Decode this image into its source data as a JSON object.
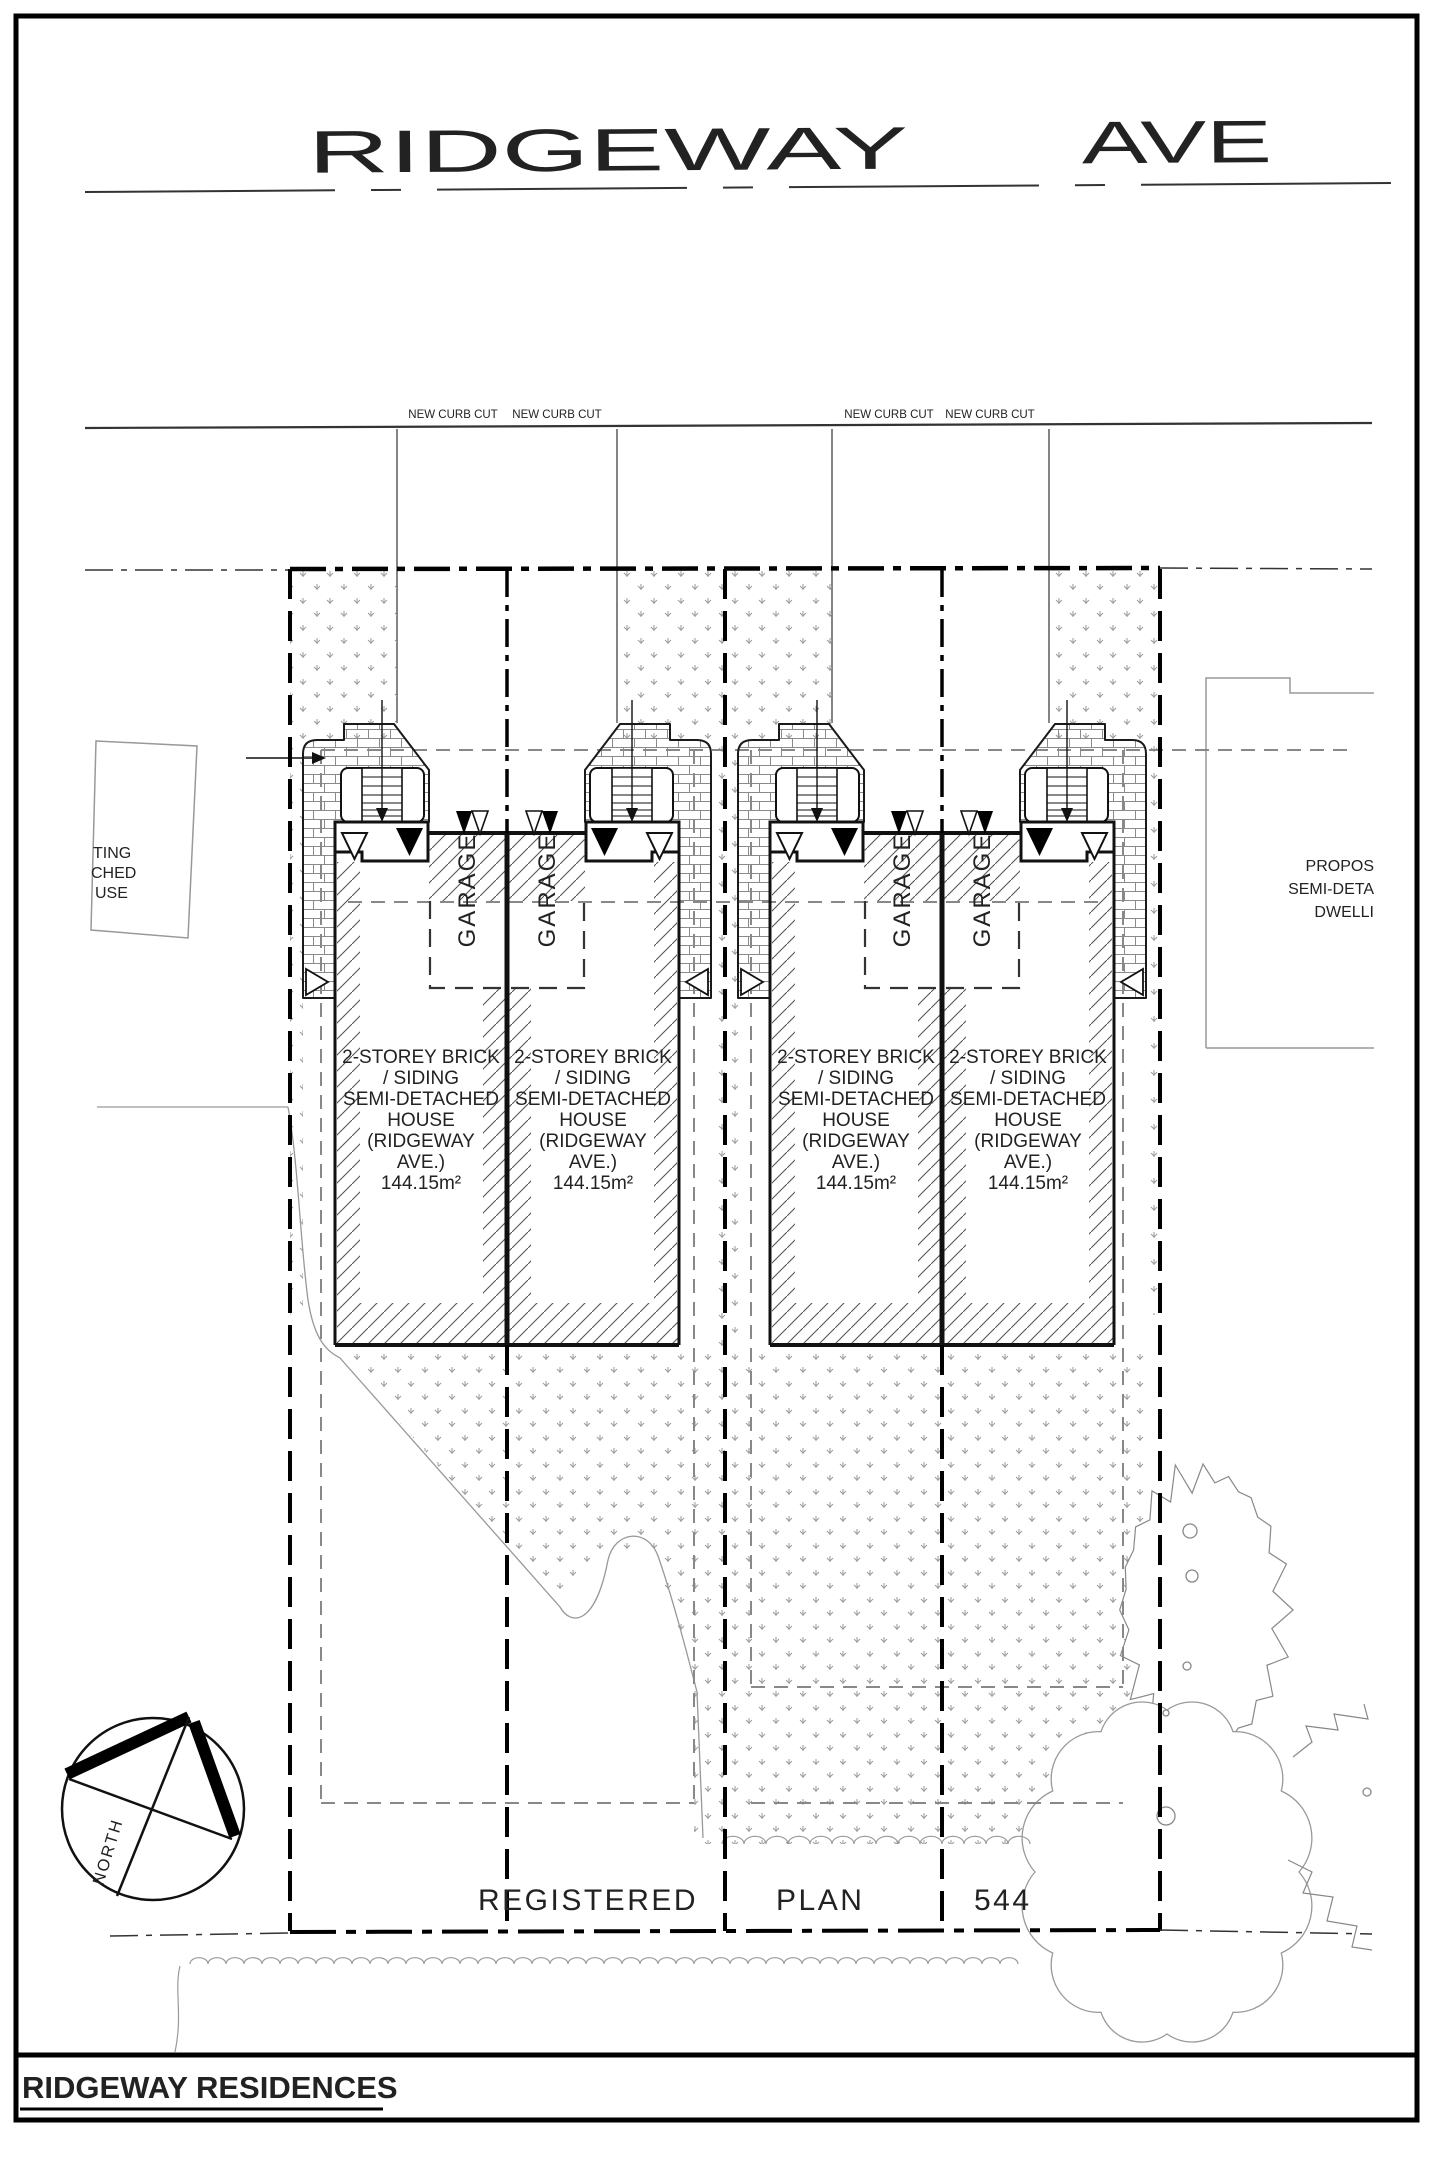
{
  "street": {
    "name_main": "RIDGEWAY",
    "name_suffix": "AVE"
  },
  "curb_cut_labels": [
    "NEW CURB CUT",
    "NEW CURB CUT",
    "NEW CURB CUT",
    "NEW CURB CUT"
  ],
  "house_label": {
    "lines": [
      "2-STOREY BRICK",
      "/ SIDING",
      "SEMI-DETACHED",
      "HOUSE",
      "(RIDGEWAY",
      "AVE.)",
      "144.15m²"
    ]
  },
  "garage_label": "GARAGE",
  "registered_plan": {
    "word1": "REGISTERED",
    "word2": "PLAN",
    "number": "544"
  },
  "compass": {
    "label": "NORTH"
  },
  "existing_house": {
    "lines": [
      "TING",
      "CHED",
      "USE"
    ]
  },
  "proposed_dwelling": {
    "lines": [
      "PROPOS",
      "SEMI-DETA",
      "DWELLI"
    ]
  },
  "title_block": {
    "title": "RIDGEWAY RESIDENCES"
  },
  "colors": {
    "ink": "#111111",
    "gray_line": "#999999",
    "gray_text": "#a0a0a0",
    "stipple": "#9a9a9a",
    "brick": "#8a8a8a",
    "hatch": "#555555"
  }
}
